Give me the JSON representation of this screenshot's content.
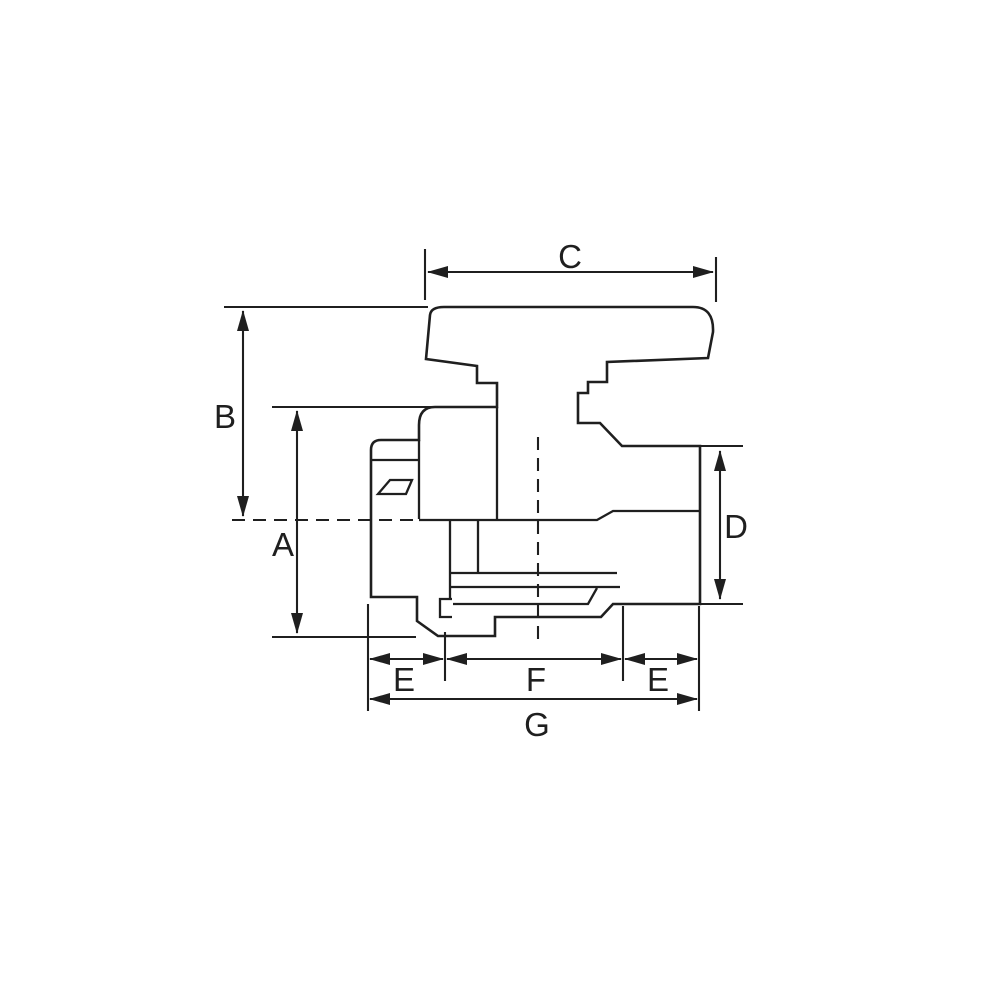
{
  "figure": {
    "type": "technical-drawing",
    "subject": "ball-valve side elevation with dimension callouts",
    "background_color": "#ffffff",
    "line_color": "#1f1f1f"
  },
  "labels": {
    "dim_a": "A",
    "dim_b": "B",
    "dim_c": "C",
    "dim_d": "D",
    "dim_e_left": "E",
    "dim_f": "F",
    "dim_e_right": "E",
    "dim_g": "G"
  }
}
